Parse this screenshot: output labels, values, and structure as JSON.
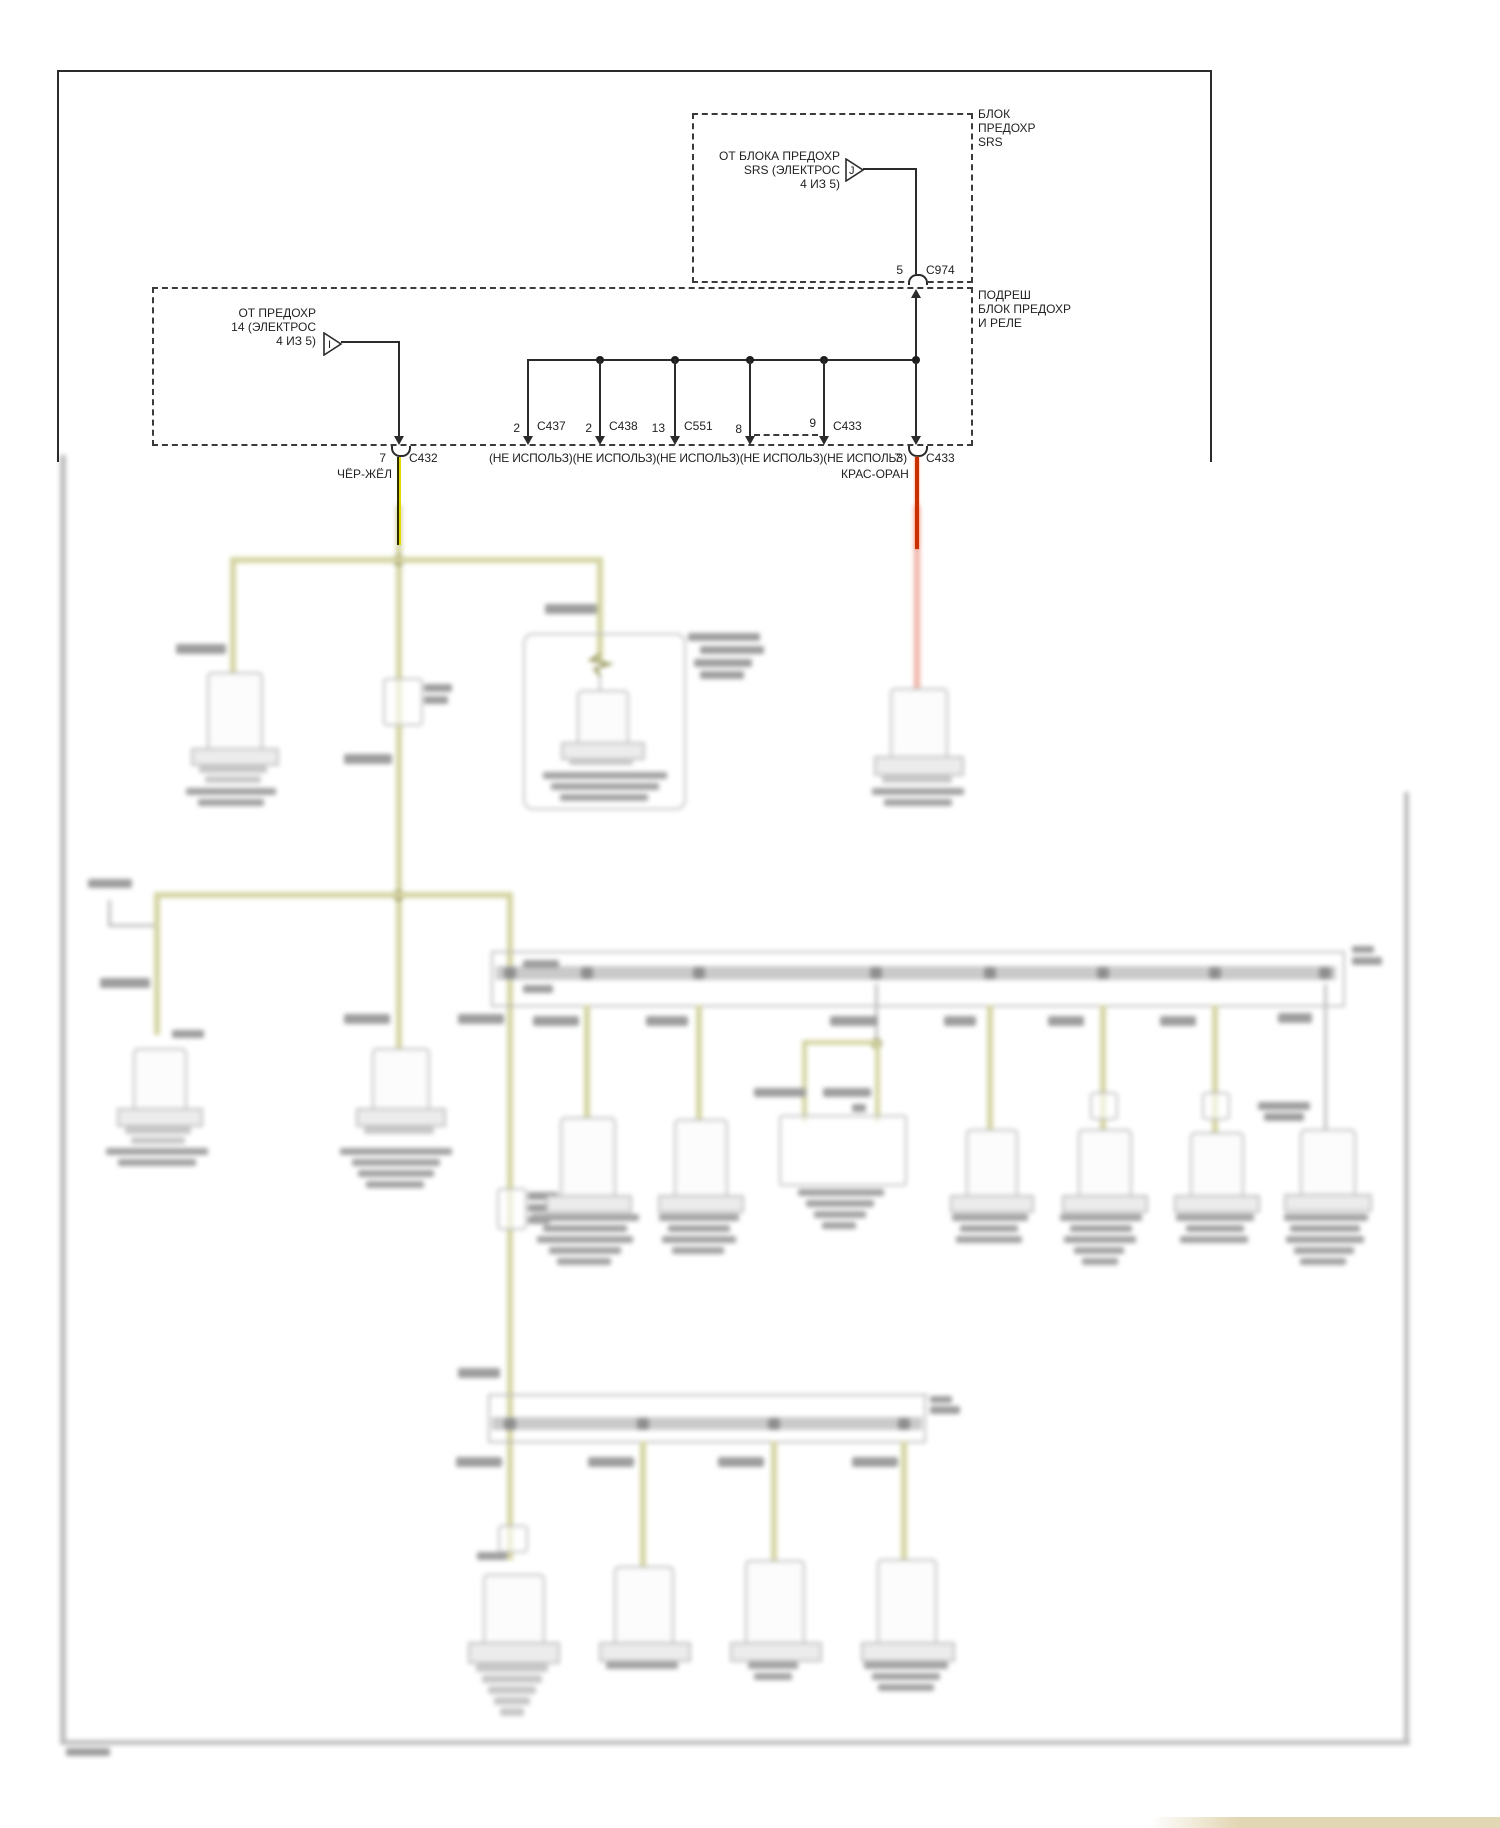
{
  "diagram_title": "Ground Distribution wiring diagram (Russian)",
  "top_section": {
    "srs_box": {
      "label": "БЛОК\nПРЕДОХР\nSRS",
      "source_label": "ОТ БЛОКА ПРЕДОХР\nSRS (ЭЛЕКТРОС\n4 ИЗ 5)",
      "triangle_letter": "J",
      "connector": {
        "pin": "5",
        "name": "C974"
      }
    },
    "underhood_box": {
      "label": "ПОДРЕШ\nБЛОК ПРЕДОХР\nИ РЕЛЕ",
      "source_label": "ОТ ПРЕДОХР\n14 (ЭЛЕКТРОС\n4 ИЗ 5)",
      "triangle_letter": "I"
    },
    "left_connector": {
      "pin": "7",
      "name": "C432",
      "wire_color_label": "ЧЁР-ЖЁЛ"
    },
    "right_connector": {
      "pin": "7",
      "name": "C433",
      "wire_color_label": "КРАС-ОРАН"
    },
    "bus_drops": [
      {
        "pin": "2",
        "name": "C437"
      },
      {
        "pin": "2",
        "name": "C438"
      },
      {
        "pin": "13",
        "name": "C551"
      },
      {
        "pin": "8",
        "name": ""
      },
      {
        "pin": "9",
        "name": "C433"
      }
    ],
    "not_used_row": "(НЕ ИСПОЛЬЗ)(НЕ ИСПОЛЬЗ)(НЕ ИСПОЛЬЗ)(НЕ ИСПОЛЬЗ)(НЕ ИСПОЛЬЗ)"
  },
  "colors": {
    "wire_black": "#2e2e00",
    "wire_yellow": "#e3d800",
    "wire_red_orange": "#c93000",
    "blur_olive": "#d4d4a2",
    "blur_red": "#f0b2a6",
    "blur_gray": "#bdbdbd"
  }
}
